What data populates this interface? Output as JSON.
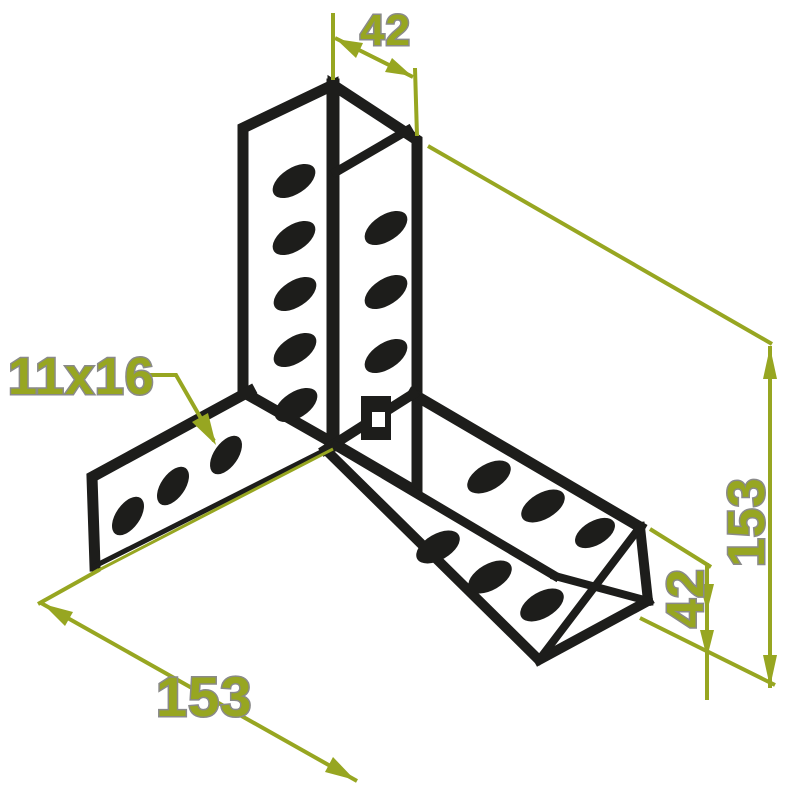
{
  "drawing": {
    "labels": {
      "top_width": "42",
      "slot_size": "11x16",
      "bottom_length": "153",
      "side_height": "153",
      "flange_width": "42"
    },
    "colors": {
      "outline": "#1d1d1b",
      "dimension": "#97a621",
      "halo": "#8a8a8a",
      "background": "#ffffff"
    }
  }
}
